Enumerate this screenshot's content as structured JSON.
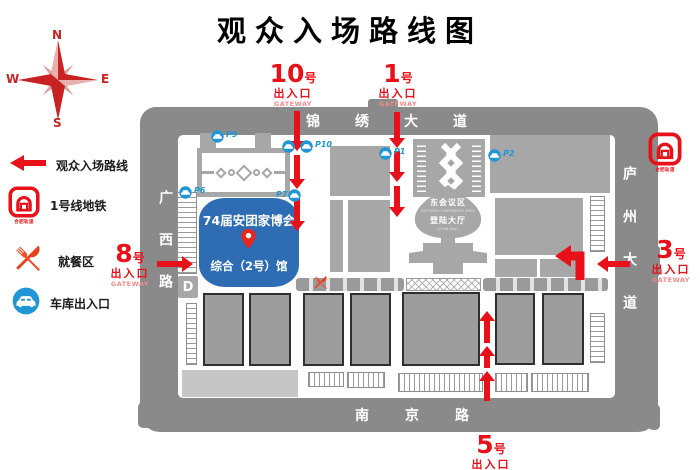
{
  "title": "观众入场路线图",
  "compass": {
    "north": "N",
    "south": "S",
    "east": "E",
    "west": "W"
  },
  "legend": {
    "items": [
      {
        "icon": "route-arrow-icon",
        "label": "观众入场路线"
      },
      {
        "icon": "metro-logo-icon",
        "label": "1号线地铁"
      },
      {
        "icon": "dining-icon",
        "label": "就餐区"
      },
      {
        "icon": "garage-icon",
        "label": "车库出入口"
      }
    ]
  },
  "gateways": {
    "g10": {
      "number": "10",
      "unit": "号",
      "entrance": "出入口",
      "caption": "GATEWAY"
    },
    "g1": {
      "number": "1",
      "unit": "号",
      "entrance": "出入口",
      "caption": "GATEWAY"
    },
    "g8": {
      "number": "8",
      "unit": "号",
      "entrance": "出入口",
      "caption": "GATEWAY"
    },
    "g3": {
      "number": "3",
      "unit": "号",
      "entrance": "出入口",
      "caption": "GATEWAY"
    },
    "g5": {
      "number": "5",
      "unit": "号",
      "entrance": "出入口",
      "caption": "GATEWAY"
    }
  },
  "roads": {
    "top": "锦绣大道",
    "left": "广西路",
    "right": "庐州大道",
    "bottom": "南京路"
  },
  "main_hall": {
    "title": "74届安团家博会",
    "subtitle": "综合（2号）馆"
  },
  "center_building": {
    "area": "东会议区",
    "area_caption": "EASTERN CONFERENCE AREA",
    "hall": "登陆大厅",
    "hall_caption": "LOGIN HALL"
  },
  "parking": {
    "p9": "P9",
    "p10": "P10",
    "p7": "P7",
    "p6": "P6",
    "p1": "P1",
    "p2": "P2"
  },
  "metro_logo": {
    "text": "合肥轨道"
  },
  "garage_door": {
    "label": "D"
  },
  "colors": {
    "route_red": "#e8111a",
    "gateway_caption_pink": "#ef8b8b",
    "hall_blue": "#2e6db4",
    "parking_blue": "#2196d4",
    "road_gray": "#8a8a8a",
    "building_gray": "#a7a7a7",
    "dining_orange": "#f0512a"
  }
}
